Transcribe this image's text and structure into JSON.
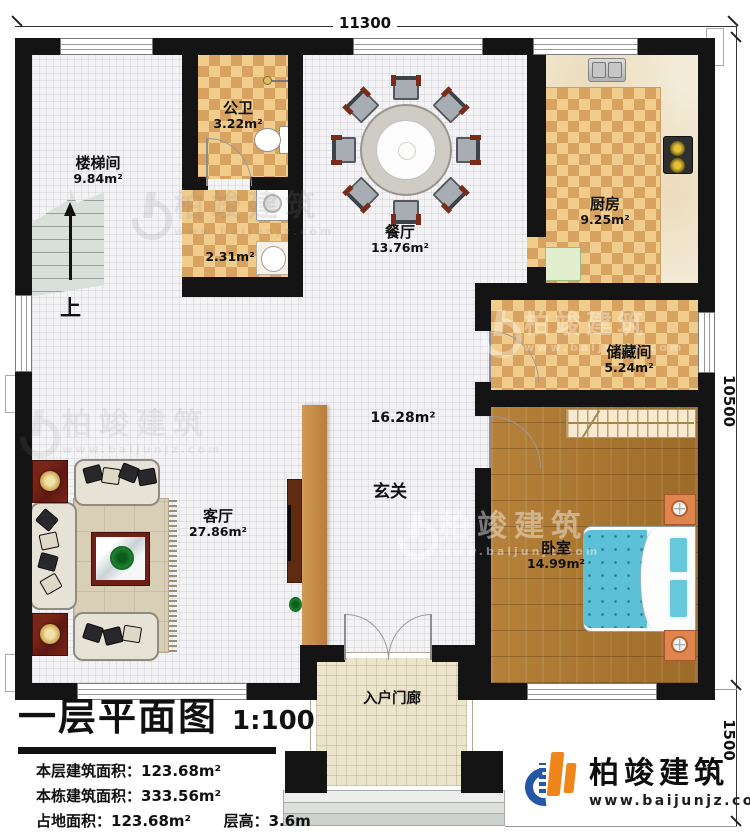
{
  "plan": {
    "dimensions": {
      "top": "11300",
      "side": "10500",
      "porch_side": "1500"
    },
    "rooms": {
      "stairwell": {
        "name": "楼梯间",
        "area": "9.84m²"
      },
      "bathroom": {
        "name": "公卫",
        "area": "3.22m²"
      },
      "laundry": {
        "area": "2.31m²"
      },
      "dining": {
        "name": "餐厅",
        "area": "13.76m²"
      },
      "kitchen": {
        "name": "厨房",
        "area": "9.25m²"
      },
      "storage": {
        "name": "储藏间",
        "area": "5.24m²"
      },
      "foyer": {
        "name": "玄关",
        "area": "16.28m²"
      },
      "living": {
        "name": "客厅",
        "area": "27.86m²"
      },
      "bedroom": {
        "name": "卧室",
        "area": "14.99m²"
      },
      "porch": {
        "name": "入户门廊"
      }
    },
    "stairs_up": "上"
  },
  "title_block": {
    "title": "一层平面图",
    "scale": "1:100",
    "stats": [
      {
        "label": "本层建筑面积：",
        "value": "123.68m²"
      },
      {
        "label": "本栋建筑面积：",
        "value": "333.56m²"
      },
      {
        "label": "占地面积：",
        "value": "123.68m²"
      },
      {
        "label": "层高：",
        "value": "3.6m"
      }
    ]
  },
  "branding": {
    "name": "柏竣建筑",
    "url": "www.baijunjz.com"
  },
  "watermark": {
    "name": "柏竣建筑",
    "url": "www.baijunjz.com"
  },
  "colors": {
    "wall": "#141414",
    "checker": "#d8a360",
    "wood": "#a9762f",
    "bed": "#5cc0d6",
    "brand_blue": "#2458a6",
    "brand_orange": "#f08519"
  }
}
